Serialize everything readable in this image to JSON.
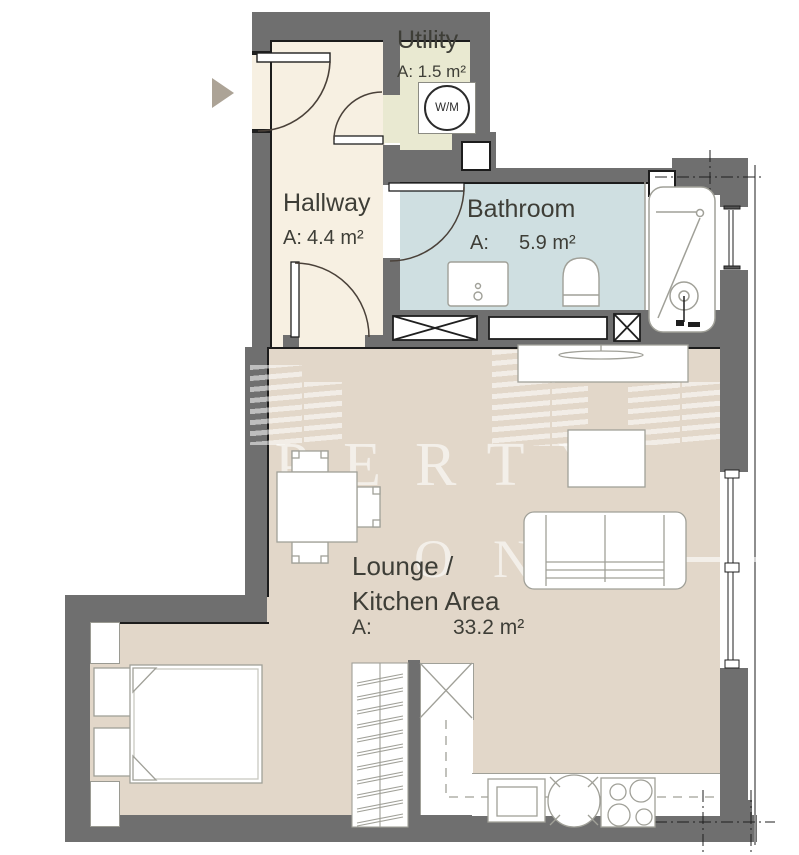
{
  "rooms": {
    "utility": {
      "name": "Utility",
      "area_label": "A:",
      "area_value": "1.5 m²"
    },
    "hallway": {
      "name": "Hallway",
      "area_label": "A:",
      "area_value": "4.4 m²"
    },
    "bathroom": {
      "name": "Bathroom",
      "area_label": "A:",
      "area_value": "5.9 m²"
    },
    "lounge_kitchen": {
      "name_line1": "Lounge /",
      "name_line2": "Kitchen Area",
      "area_label": "A:",
      "area_value": "33.2 m²"
    }
  },
  "appliances": {
    "washer_label": "W/M"
  },
  "watermark": {
    "line1": "PROPERTY",
    "line2": "ONE"
  },
  "colors": {
    "wall": "#6f6f6f",
    "hallway_floor": "#f7f0e2",
    "utility_floor": "#e9e9d1",
    "bathroom_floor": "#cfdfe1",
    "lounge_floor": "#e2d7c9",
    "entrance_arrow": "#aca396",
    "label_text": "#3e3e37",
    "furniture_line": "#a0a098"
  }
}
